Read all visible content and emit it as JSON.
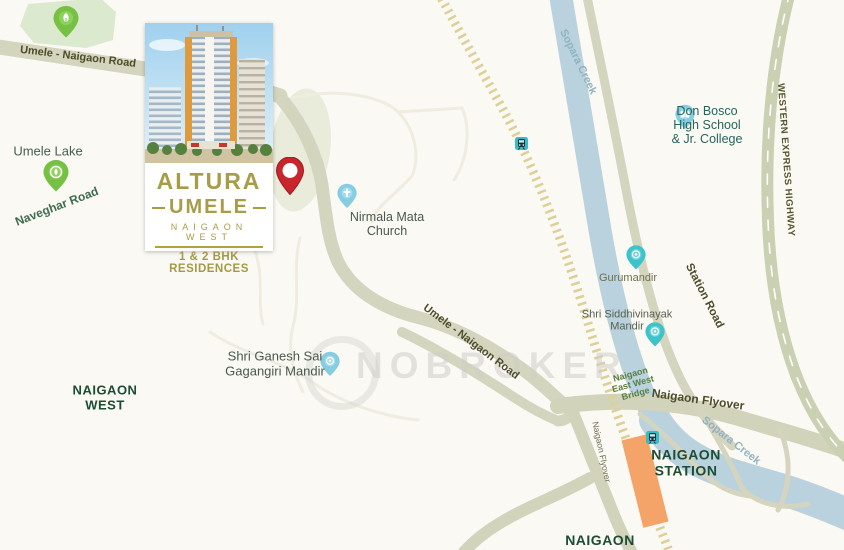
{
  "watermark": {
    "text": "NOBROKER"
  },
  "project_card": {
    "title": "ALTURA",
    "name": "UMELE",
    "location": "NAIGAON WEST",
    "tagline": "1 & 2 BHK RESIDENCES"
  },
  "labels": {
    "umele_naigaon_road_top": "Umele - Naigaon Road",
    "umele_lake": "Umele Lake",
    "naveghar_road": "Naveghar Road",
    "nirmala_mata_church": "Nirmala Mata\nChurch",
    "don_bosco": "Don Bosco\nHigh School\n& Jr. College",
    "sopara_creek_top": "Sopara Creek",
    "western_express_highway": "WESTERN EXPRESS HIGHWAY",
    "gurumandir": "Gurumandir",
    "shri_siddhivinayak_mandir": "Shri Siddhivinayak\nMandir",
    "station_road": "Station Road",
    "umele_naigaon_road_mid": "Umele - Naigaon Road",
    "naigaon_east_west_bridge": "Naigaon\nEast West\nBridge",
    "naigaon_flyover": "Naigaon Flyover",
    "naigaon_flyover_small": "Naigaon Flyover",
    "sopara_creek_bottom": "Sopara Creek",
    "naigaon_station": "NAIGAON\nSTATION",
    "naigaon": "NAIGAON",
    "naigaon_west": "NAIGAON\nWEST",
    "shri_ganesh_sai": "Shri Ganesh Sai\nGagangiri Mandir"
  },
  "colors": {
    "accent_gold": "#a79d48",
    "pin_red": "#c9252c",
    "pin_green": "#76c043",
    "pin_blue": "#86cde2",
    "pin_teal": "#3fc3cb",
    "station_orange": "#f4a469",
    "creek_blue": "#bad2dd",
    "road_beige": "#d4d5be",
    "railway_tan": "#decf97",
    "area_label_green": "#1b4d33"
  }
}
